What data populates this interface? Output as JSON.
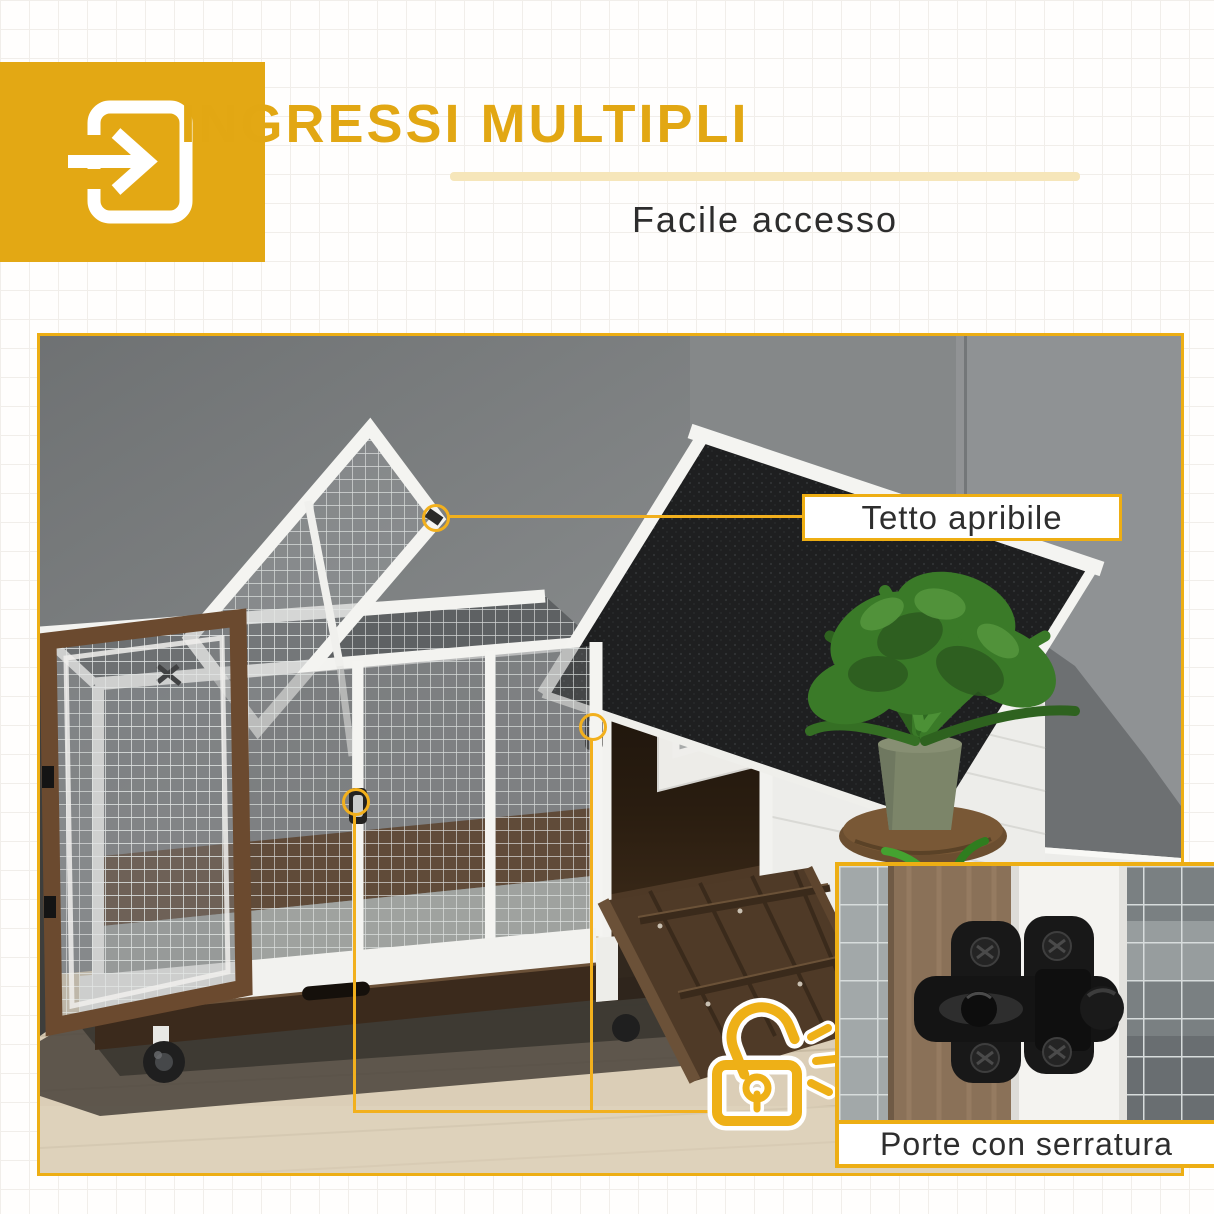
{
  "header": {
    "title": "INGRESSI MULTIPLI",
    "subtitle": "Facile accesso"
  },
  "callouts": {
    "roof_label": "Tetto apribile",
    "inset_caption": "Porte con serratura"
  },
  "icons": {
    "entry_icon": "box-arrow-in-right-icon",
    "padlock_icon": "unlocked-padlock-icon"
  },
  "colors": {
    "accent_yellow": "#E9AC15",
    "accent_square": "#E3A814",
    "title_gold": "#E2A713",
    "pale_underline": "#F6E6BA",
    "text_dark": "#2D2D2D",
    "wall_gray": "#858889",
    "floor_wood": "#DBCEB7",
    "roof_black": "#1E1F20",
    "wood_brown": "#5C4430"
  }
}
